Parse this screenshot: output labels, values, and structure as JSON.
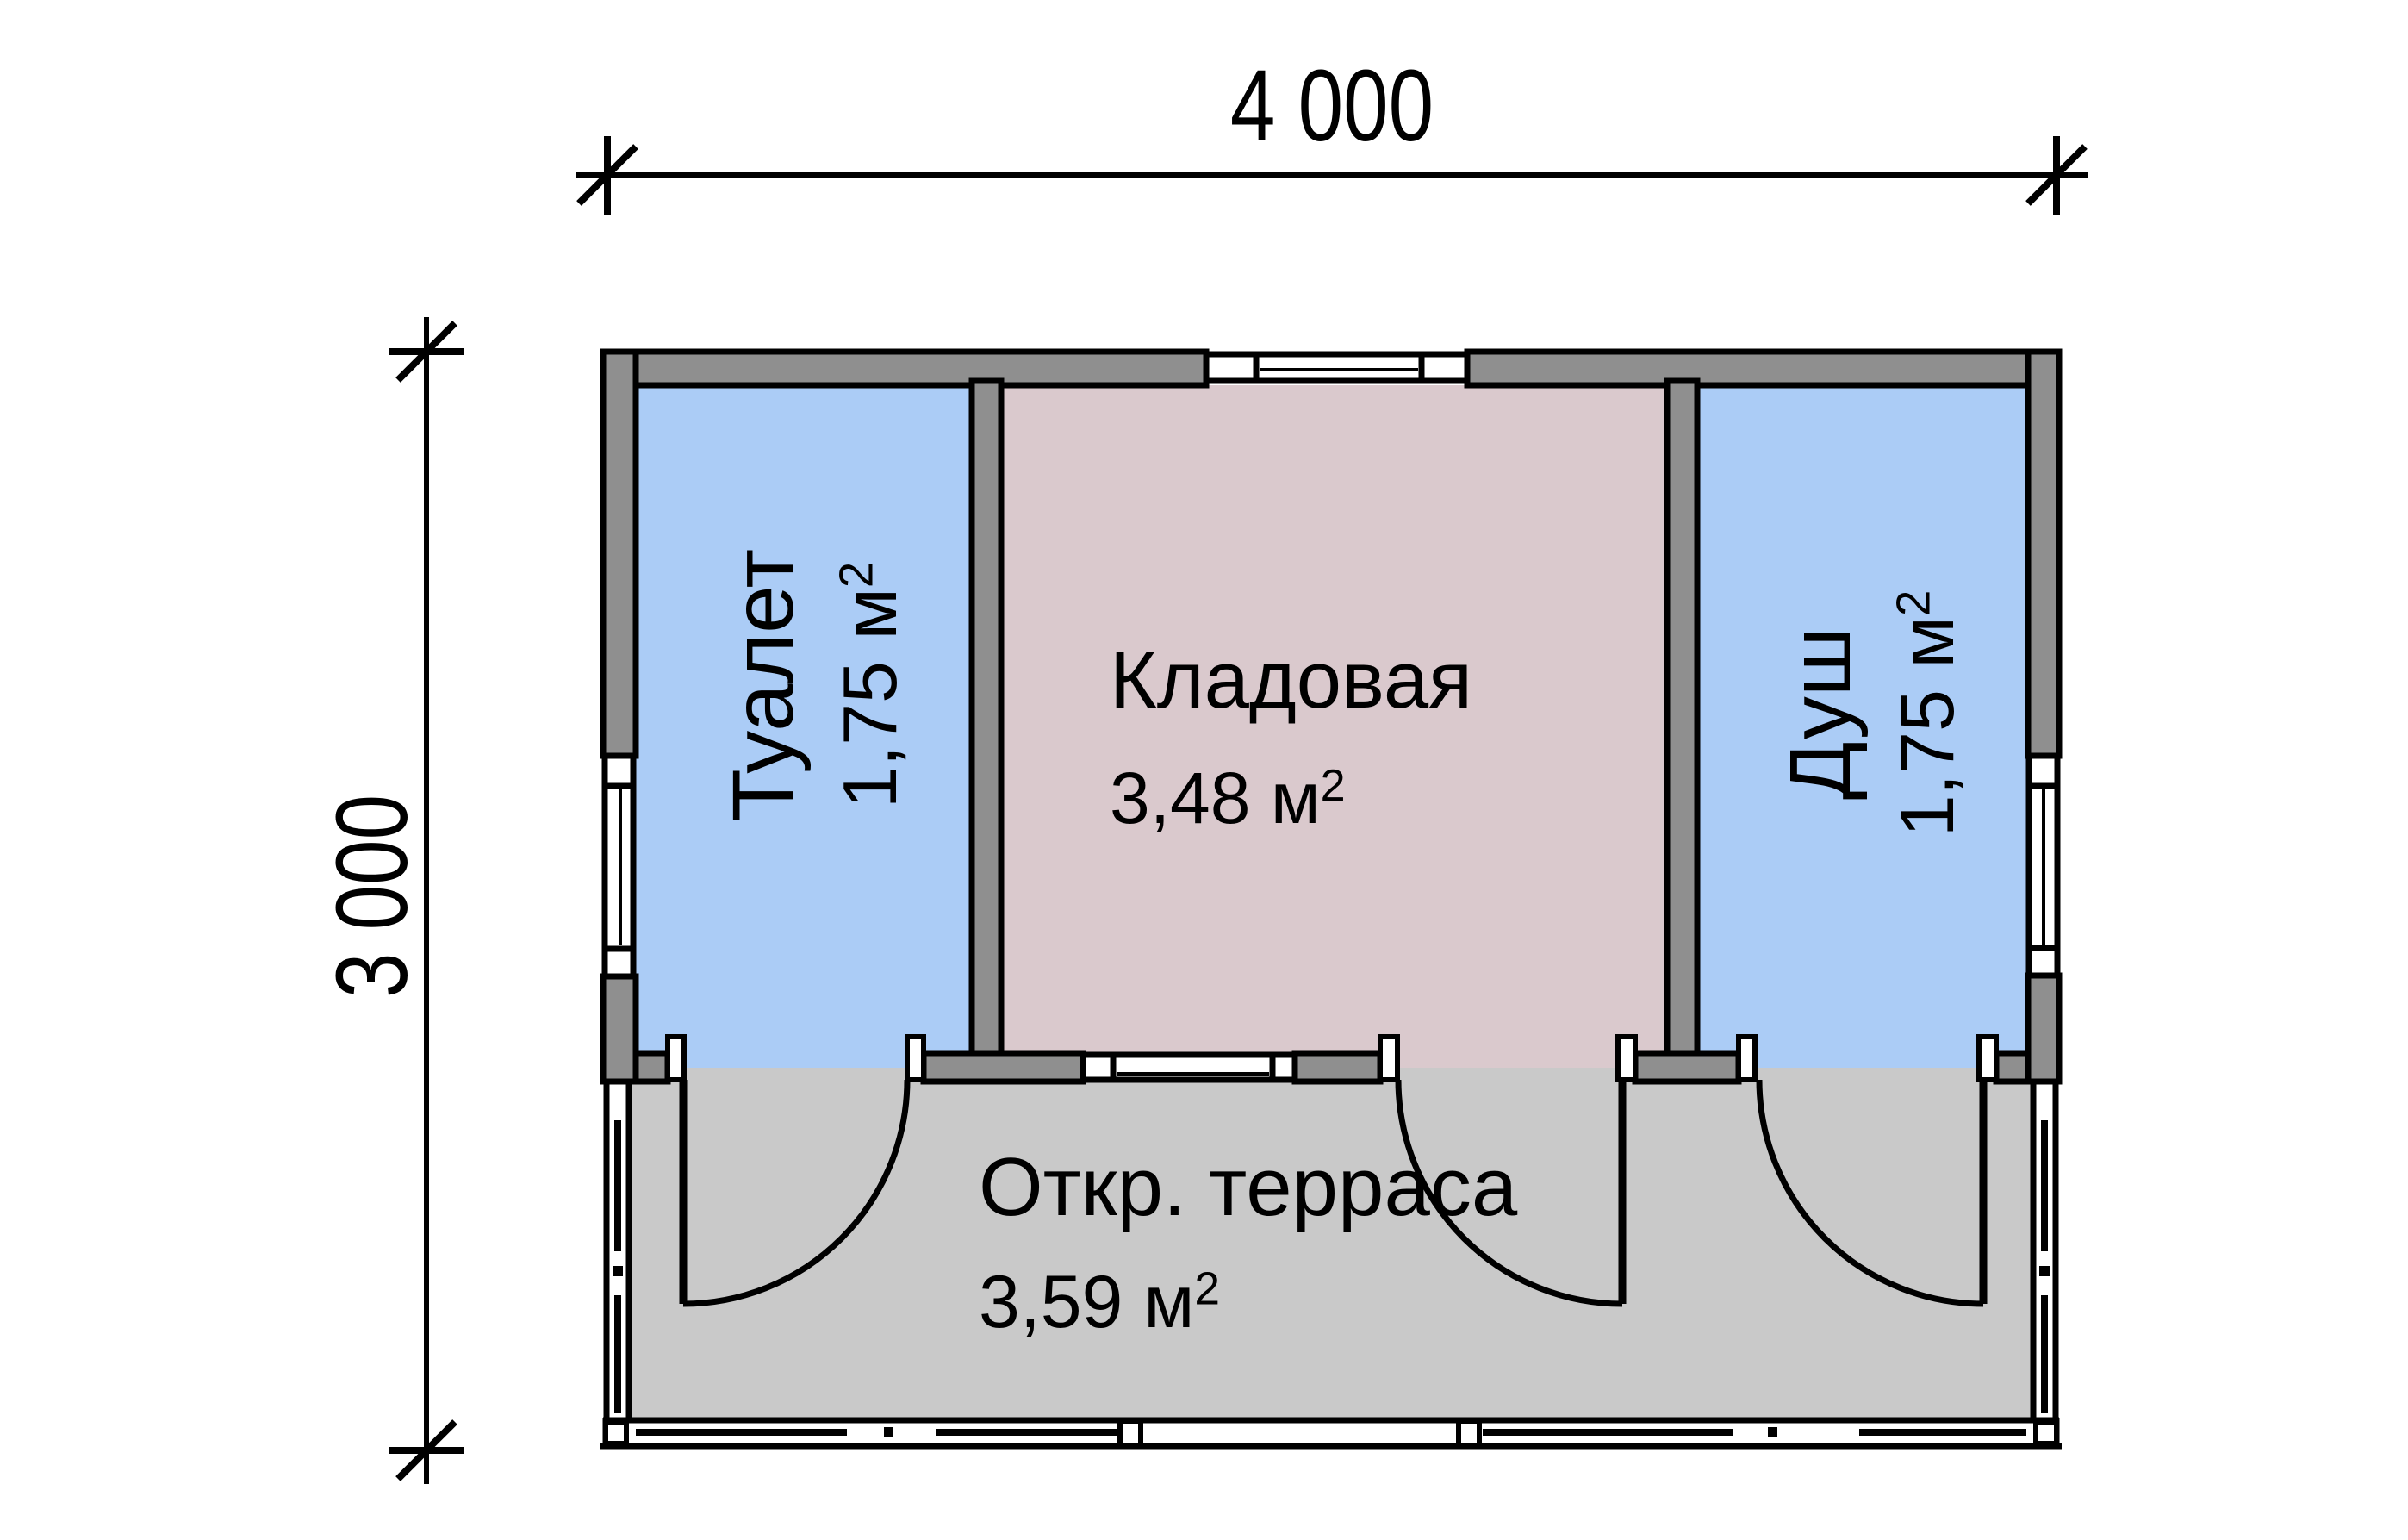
{
  "plan": {
    "title": "floor-plan",
    "dimensions": {
      "width_label": "4 000",
      "height_label": "3 000"
    },
    "rooms": [
      {
        "id": "toilet",
        "name": "Туалет",
        "area_base": "1,75 м",
        "area_sup": "2"
      },
      {
        "id": "storage",
        "name": "Кладовая",
        "area_base": "3,48 м",
        "area_sup": "2"
      },
      {
        "id": "shower",
        "name": "Душ",
        "area_base": "1,75 м",
        "area_sup": "2"
      },
      {
        "id": "terrace",
        "name": "Откр. терраса",
        "area_base": "3,59 м",
        "area_sup": "2"
      }
    ],
    "colors": {
      "wall": "#8f8f8f",
      "room_wet": "#abccf6",
      "room_storage": "#dac9cd",
      "terrace": "#c9c9c9",
      "line": "#000000",
      "background": "#ffffff"
    }
  }
}
